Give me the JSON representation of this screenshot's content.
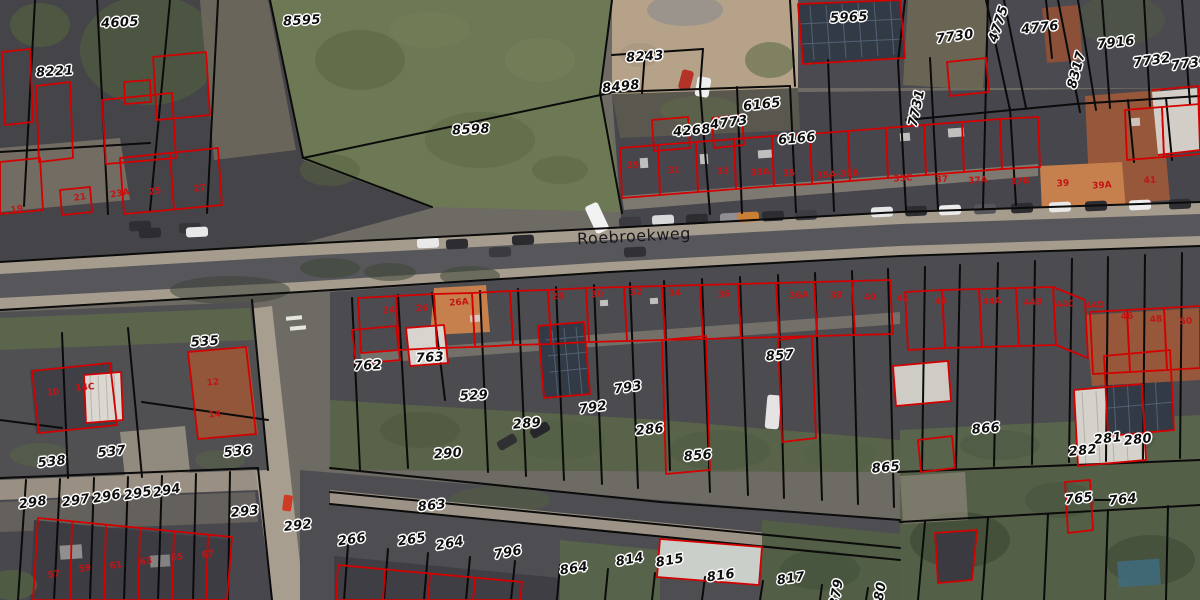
{
  "map": {
    "type": "cadastral-aerial-map",
    "street": {
      "name": "Roebroekweg",
      "x": 634,
      "y": 236,
      "rot": -3
    },
    "colors": {
      "parcel-line": "#0b0b0b",
      "building-line": "#d40000",
      "house-number-color": "#c41414",
      "label-halo": "#ffffff",
      "highlight-soil": "#c6804e",
      "grass": "#6d7954",
      "road": "#57575b",
      "pavement": "#a59c8e"
    },
    "parcel_labels": [
      {
        "text": "4605",
        "x": 120,
        "y": 23,
        "rot": -3
      },
      {
        "text": "8221",
        "x": 55,
        "y": 72,
        "rot": -4
      },
      {
        "text": "8595",
        "x": 302,
        "y": 21,
        "rot": -3
      },
      {
        "text": "8598",
        "x": 471,
        "y": 130,
        "rot": -3
      },
      {
        "text": "8243",
        "x": 645,
        "y": 57,
        "rot": -4
      },
      {
        "text": "8498",
        "x": 621,
        "y": 87,
        "rot": -6
      },
      {
        "text": "4268",
        "x": 692,
        "y": 131,
        "rot": -5
      },
      {
        "text": "4773",
        "x": 729,
        "y": 123,
        "rot": -8
      },
      {
        "text": "6165",
        "x": 762,
        "y": 105,
        "rot": -6
      },
      {
        "text": "6166",
        "x": 797,
        "y": 139,
        "rot": -5
      },
      {
        "text": "5965",
        "x": 849,
        "y": 18,
        "rot": -3
      },
      {
        "text": "7730",
        "x": 955,
        "y": 37,
        "rot": -8
      },
      {
        "text": "7731",
        "x": 917,
        "y": 108,
        "rot": -78
      },
      {
        "text": "4775",
        "x": 999,
        "y": 24,
        "rot": -72
      },
      {
        "text": "4776",
        "x": 1040,
        "y": 28,
        "rot": -6
      },
      {
        "text": "8317",
        "x": 1077,
        "y": 70,
        "rot": -75
      },
      {
        "text": "7916",
        "x": 1116,
        "y": 43,
        "rot": -6
      },
      {
        "text": "7732",
        "x": 1152,
        "y": 61,
        "rot": -8
      },
      {
        "text": "7733",
        "x": 1190,
        "y": 64,
        "rot": -8
      },
      {
        "text": "535",
        "x": 205,
        "y": 342,
        "rot": -4
      },
      {
        "text": "762",
        "x": 368,
        "y": 366,
        "rot": -3
      },
      {
        "text": "763",
        "x": 430,
        "y": 358,
        "rot": -3
      },
      {
        "text": "529",
        "x": 474,
        "y": 396,
        "rot": -3
      },
      {
        "text": "289",
        "x": 527,
        "y": 424,
        "rot": -5
      },
      {
        "text": "290",
        "x": 448,
        "y": 454,
        "rot": -4
      },
      {
        "text": "792",
        "x": 593,
        "y": 408,
        "rot": -8
      },
      {
        "text": "793",
        "x": 628,
        "y": 388,
        "rot": -8
      },
      {
        "text": "286",
        "x": 650,
        "y": 430,
        "rot": -6
      },
      {
        "text": "857",
        "x": 780,
        "y": 356,
        "rot": -4
      },
      {
        "text": "856",
        "x": 698,
        "y": 456,
        "rot": -5
      },
      {
        "text": "865",
        "x": 886,
        "y": 468,
        "rot": -5
      },
      {
        "text": "866",
        "x": 986,
        "y": 429,
        "rot": -5
      },
      {
        "text": "281",
        "x": 1108,
        "y": 439,
        "rot": -6
      },
      {
        "text": "280",
        "x": 1138,
        "y": 440,
        "rot": -6
      },
      {
        "text": "282",
        "x": 1083,
        "y": 451,
        "rot": -6
      },
      {
        "text": "765",
        "x": 1079,
        "y": 499,
        "rot": -6
      },
      {
        "text": "764",
        "x": 1123,
        "y": 500,
        "rot": -6
      },
      {
        "text": "537",
        "x": 112,
        "y": 452,
        "rot": -6
      },
      {
        "text": "538",
        "x": 52,
        "y": 462,
        "rot": -6
      },
      {
        "text": "536",
        "x": 238,
        "y": 452,
        "rot": -5
      },
      {
        "text": "298",
        "x": 33,
        "y": 503,
        "rot": -8
      },
      {
        "text": "297",
        "x": 76,
        "y": 501,
        "rot": -8
      },
      {
        "text": "296",
        "x": 107,
        "y": 497,
        "rot": -10
      },
      {
        "text": "295",
        "x": 138,
        "y": 494,
        "rot": -10
      },
      {
        "text": "294",
        "x": 167,
        "y": 491,
        "rot": -10
      },
      {
        "text": "293",
        "x": 245,
        "y": 512,
        "rot": -6
      },
      {
        "text": "292",
        "x": 298,
        "y": 526,
        "rot": -6
      },
      {
        "text": "266",
        "x": 352,
        "y": 540,
        "rot": -8
      },
      {
        "text": "265",
        "x": 412,
        "y": 540,
        "rot": -8
      },
      {
        "text": "264",
        "x": 450,
        "y": 544,
        "rot": -10
      },
      {
        "text": "796",
        "x": 508,
        "y": 553,
        "rot": -10
      },
      {
        "text": "863",
        "x": 432,
        "y": 506,
        "rot": -6
      },
      {
        "text": "864",
        "x": 574,
        "y": 569,
        "rot": -8
      },
      {
        "text": "814",
        "x": 630,
        "y": 560,
        "rot": -10
      },
      {
        "text": "815",
        "x": 670,
        "y": 561,
        "rot": -10
      },
      {
        "text": "816",
        "x": 721,
        "y": 576,
        "rot": -8
      },
      {
        "text": "817",
        "x": 791,
        "y": 579,
        "rot": -8
      },
      {
        "text": "879",
        "x": 837,
        "y": 593,
        "rot": -80
      },
      {
        "text": "880",
        "x": 880,
        "y": 596,
        "rot": -80
      }
    ],
    "house_numbers": [
      {
        "text": "19",
        "x": 17,
        "y": 210,
        "rot": -10
      },
      {
        "text": "21",
        "x": 80,
        "y": 198,
        "rot": -10
      },
      {
        "text": "23A",
        "x": 120,
        "y": 194,
        "rot": -10
      },
      {
        "text": "25",
        "x": 155,
        "y": 192,
        "rot": -10
      },
      {
        "text": "27",
        "x": 200,
        "y": 189,
        "rot": -10
      },
      {
        "text": "29",
        "x": 633,
        "y": 166,
        "rot": -4
      },
      {
        "text": "31",
        "x": 674,
        "y": 171,
        "rot": -4
      },
      {
        "text": "33",
        "x": 723,
        "y": 172,
        "rot": -4
      },
      {
        "text": "33A",
        "x": 760,
        "y": 173,
        "rot": -4
      },
      {
        "text": "35",
        "x": 789,
        "y": 174,
        "rot": -4
      },
      {
        "text": "35A-35B",
        "x": 838,
        "y": 175,
        "rot": -4
      },
      {
        "text": "35C",
        "x": 903,
        "y": 179,
        "rot": -4
      },
      {
        "text": "37",
        "x": 942,
        "y": 180,
        "rot": -4
      },
      {
        "text": "37A",
        "x": 978,
        "y": 181,
        "rot": -4
      },
      {
        "text": "37B",
        "x": 1020,
        "y": 182,
        "rot": -4
      },
      {
        "text": "39",
        "x": 1063,
        "y": 184,
        "rot": -4
      },
      {
        "text": "39A",
        "x": 1102,
        "y": 186,
        "rot": -4
      },
      {
        "text": "41",
        "x": 1150,
        "y": 181,
        "rot": -4
      },
      {
        "text": "24",
        "x": 389,
        "y": 311,
        "rot": -4
      },
      {
        "text": "26",
        "x": 422,
        "y": 309,
        "rot": -4
      },
      {
        "text": "26A",
        "x": 459,
        "y": 303,
        "rot": -4
      },
      {
        "text": "28",
        "x": 558,
        "y": 297,
        "rot": -4
      },
      {
        "text": "30",
        "x": 597,
        "y": 295,
        "rot": -4
      },
      {
        "text": "32",
        "x": 636,
        "y": 293,
        "rot": -4
      },
      {
        "text": "34",
        "x": 675,
        "y": 294,
        "rot": -4
      },
      {
        "text": "36",
        "x": 724,
        "y": 295,
        "rot": -4
      },
      {
        "text": "36A",
        "x": 799,
        "y": 296,
        "rot": -4
      },
      {
        "text": "38",
        "x": 836,
        "y": 296,
        "rot": -4
      },
      {
        "text": "40",
        "x": 870,
        "y": 298,
        "rot": -4
      },
      {
        "text": "42",
        "x": 903,
        "y": 299,
        "rot": -4
      },
      {
        "text": "44",
        "x": 941,
        "y": 302,
        "rot": -4
      },
      {
        "text": "44A",
        "x": 992,
        "y": 302,
        "rot": -4
      },
      {
        "text": "44B",
        "x": 1033,
        "y": 303,
        "rot": -4
      },
      {
        "text": "44C",
        "x": 1065,
        "y": 305,
        "rot": -4
      },
      {
        "text": "44D",
        "x": 1095,
        "y": 306,
        "rot": -4
      },
      {
        "text": "46",
        "x": 1127,
        "y": 317,
        "rot": -4
      },
      {
        "text": "48",
        "x": 1156,
        "y": 320,
        "rot": -4
      },
      {
        "text": "50",
        "x": 1186,
        "y": 322,
        "rot": -4
      },
      {
        "text": "10",
        "x": 53,
        "y": 393,
        "rot": -5
      },
      {
        "text": "14C",
        "x": 85,
        "y": 388,
        "rot": -5
      },
      {
        "text": "12",
        "x": 213,
        "y": 383,
        "rot": -5
      },
      {
        "text": "14",
        "x": 215,
        "y": 415,
        "rot": -5
      },
      {
        "text": "57",
        "x": 54,
        "y": 575,
        "rot": -8
      },
      {
        "text": "59",
        "x": 85,
        "y": 569,
        "rot": -8
      },
      {
        "text": "61",
        "x": 116,
        "y": 566,
        "rot": -8
      },
      {
        "text": "63",
        "x": 146,
        "y": 562,
        "rot": -8
      },
      {
        "text": "65",
        "x": 177,
        "y": 558,
        "rot": -8
      },
      {
        "text": "67",
        "x": 208,
        "y": 555,
        "rot": -8
      }
    ]
  }
}
